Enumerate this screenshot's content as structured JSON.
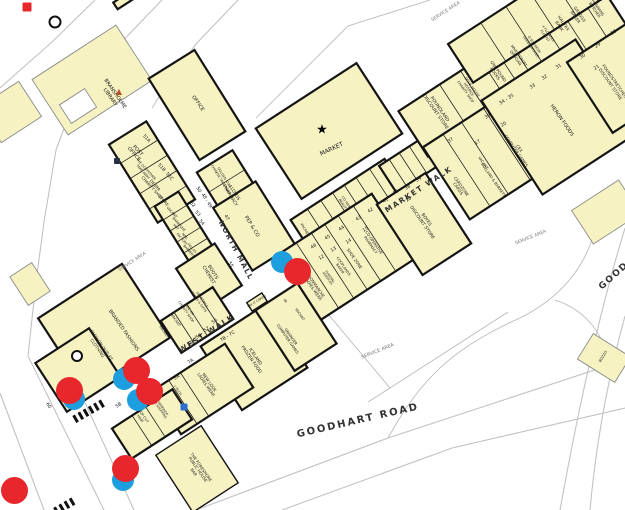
{
  "map": {
    "colors": {
      "building_fill": "#f7f2c2",
      "outline_heavy": "#141414",
      "outline_light": "#8a8a8a",
      "road": "#c2c2c2",
      "marker_red": "#e8272c",
      "marker_blue": "#1d9fdf",
      "triangle_symbol": "#b4532a",
      "phone_symbol": "#2d6fd1"
    },
    "streets": [
      {
        "t": "NORTH MALL",
        "x": 235,
        "y": 251,
        "rot": 62,
        "size": 7,
        "ls": 1.5
      },
      {
        "t": "MARKET WALK",
        "x": 419,
        "y": 190,
        "rot": -33,
        "size": 7.5,
        "ls": 1.5
      },
      {
        "t": "WEST WALK",
        "x": 207,
        "y": 334,
        "rot": -33,
        "size": 7.5,
        "ls": 1.5
      },
      {
        "t": "GOODHART ROAD",
        "x": 358,
        "y": 421,
        "rot": -13,
        "size": 10,
        "ls": 2
      },
      {
        "t": "GOODHART ROAD",
        "x": 641,
        "y": 252,
        "rot": -42,
        "size": 9,
        "ls": 1.5
      }
    ],
    "areas": [
      {
        "t": "SERVICE AREA",
        "x": 446,
        "y": 12,
        "rot": -33,
        "size": 4.6
      },
      {
        "t": "SERVICE AREA",
        "x": 133,
        "y": 263,
        "rot": -33,
        "size": 4.4
      },
      {
        "t": "SERVICE AREA",
        "x": 531,
        "y": 238,
        "rot": -22,
        "size": 4.6
      },
      {
        "t": "SERVICE AREA",
        "x": 378,
        "y": 352,
        "rot": -22,
        "size": 4.8
      }
    ],
    "units": [
      {
        "name": "bransholme-library",
        "lines": [
          "BRANSHOLME",
          "LIBRARY"
        ],
        "x": 112,
        "y": 96,
        "rot": 55,
        "size": 5
      },
      {
        "name": "office",
        "lines": [
          "OFFICE"
        ],
        "x": 197,
        "y": 104,
        "rot": 55,
        "size": 5
      },
      {
        "name": "post-office",
        "lines": [
          "POST",
          "OFFICE"
        ],
        "x": 135,
        "y": 153,
        "rot": 48,
        "size": 4.8
      },
      {
        "name": "godfather-takeaway",
        "lines": [
          "THE GODFATHER",
          "TAKE AWAY"
        ],
        "x": 144,
        "y": 171,
        "rot": 48,
        "size": 3.3
      },
      {
        "name": "debra-charity",
        "lines": [
          "DEBRA",
          "CHARITY SHOP"
        ],
        "x": 153,
        "y": 187,
        "rot": 48,
        "size": 4
      },
      {
        "name": "store",
        "lines": [
          "STORE"
        ],
        "x": 163,
        "y": 201,
        "rot": 48,
        "size": 4
      },
      {
        "name": "vacant-52",
        "lines": [
          "VACANT"
        ],
        "x": 171,
        "y": 213,
        "rot": 48,
        "size": 3.5
      },
      {
        "name": "barbeque-hut",
        "lines": [
          "BARBEQUE",
          "HUT"
        ],
        "x": 177,
        "y": 226,
        "rot": 48,
        "size": 3.2
      },
      {
        "name": "nail-factory",
        "lines": [
          "NAIL",
          "FACTORY"
        ],
        "x": 183,
        "y": 238,
        "rot": 48,
        "size": 3.2
      },
      {
        "name": "fellas-barbers",
        "lines": [
          "FELLAS",
          "BARBERS"
        ],
        "x": 190,
        "y": 250,
        "rot": 48,
        "size": 3.2
      },
      {
        "name": "golden-star",
        "lines": [
          "GOLDEN STAR",
          "CHINESE TAKE AWAY"
        ],
        "x": 222,
        "y": 179,
        "rot": 58,
        "size": 3.3
      },
      {
        "name": "lloyds-pharmacy",
        "lines": [
          "LLOYDS",
          "PHARMACY"
        ],
        "x": 231,
        "y": 195,
        "rot": 58,
        "size": 4.4
      },
      {
        "name": "pep-and-co",
        "lines": [
          "PEP & CO"
        ],
        "x": 251,
        "y": 227,
        "rot": 58,
        "size": 5
      },
      {
        "name": "boots-chemist",
        "lines": [
          "BOOTS",
          "CHEMIST"
        ],
        "x": 210,
        "y": 274,
        "rot": 58,
        "size": 4.6
      },
      {
        "name": "greetings-cards",
        "lines": [
          "GREETINGS",
          "CARDS & GIFTS"
        ],
        "x": 200,
        "y": 301,
        "rot": 55,
        "size": 3.2
      },
      {
        "name": "age-uk",
        "lines": [
          "AGE UK",
          "CHARITY SHOP"
        ],
        "x": 187,
        "y": 311,
        "rot": 55,
        "size": 3.4
      },
      {
        "name": "vacant-58",
        "lines": [
          "VACANT"
        ],
        "x": 175,
        "y": 321,
        "rot": 55,
        "size": 3.5
      },
      {
        "name": "vacant-59",
        "lines": [
          "VACANT"
        ],
        "x": 163,
        "y": 332,
        "rot": 55,
        "size": 3.5
      },
      {
        "name": "branded-fashions",
        "lines": [
          "BRANDED FASHIONS"
        ],
        "x": 123,
        "y": 331,
        "rot": 55,
        "size": 4.8
      },
      {
        "name": "fashion-outlet",
        "lines": [
          "FASHION OUTLET",
          "CLOTHING"
        ],
        "x": 99,
        "y": 347,
        "rot": 55,
        "size": 4.2
      },
      {
        "name": "cards-kiosk",
        "lines": [
          "SAY IT CARDS"
        ],
        "x": 257,
        "y": 302,
        "rot": -33,
        "size": 3.1
      },
      {
        "name": "co-hair-beauty",
        "lines": [
          "CO HAIR",
          "BEAUTY"
        ],
        "x": 344,
        "y": 204,
        "rot": 55,
        "size": 3.4
      },
      {
        "name": "vacant-46",
        "lines": [
          "VACANT"
        ],
        "x": 304,
        "y": 230,
        "rot": 58,
        "size": 3.5
      },
      {
        "name": "poundland",
        "lines": [
          "POUNDLAND",
          "DISCOUNT STORE"
        ],
        "x": 437,
        "y": 111,
        "rot": 55,
        "size": 4.6
      },
      {
        "name": "dove-house-hospice",
        "lines": [
          "DOVE HOUSE",
          "HOSPICE",
          "CHARITY SHOP"
        ],
        "x": 468,
        "y": 90,
        "rot": 55,
        "size": 3.5
      },
      {
        "name": "one-pound-books",
        "lines": [
          "ONE POUND",
          "BOOKS"
        ],
        "x": 496,
        "y": 73,
        "rot": 55,
        "size": 4
      },
      {
        "name": "wheatcroft-optician",
        "lines": [
          "WHEATCROFT",
          "OPTICIAN"
        ],
        "x": 517,
        "y": 57,
        "rot": 55,
        "size": 3.7
      },
      {
        "name": "greengrocer",
        "lines": [
          "O SO FRESH",
          "GREENGROCER"
        ],
        "x": 532,
        "y": 46,
        "rot": 55,
        "size": 3.3
      },
      {
        "name": "florist",
        "lines": [
          "4 FLOWERS",
          "FLORIST"
        ],
        "x": 546,
        "y": 35,
        "rot": 55,
        "size": 3.3
      },
      {
        "name": "halifax-bank",
        "lines": [
          "HALIFAX",
          "BANK"
        ],
        "x": 561,
        "y": 25,
        "rot": 55,
        "size": 4.2
      },
      {
        "name": "greggs-baker",
        "lines": [
          "GREGGS",
          "BAKER"
        ],
        "x": 577,
        "y": 16,
        "rot": 55,
        "size": 4.2
      },
      {
        "name": "hosmans-butcher",
        "lines": [
          "HOSMANS",
          "BUTCHER"
        ],
        "x": 596,
        "y": 9,
        "rot": 55,
        "size": 3.7
      },
      {
        "name": "market-hall",
        "lines": [
          "MARKET"
        ],
        "x": 332,
        "y": 150,
        "rot": -25,
        "size": 6
      },
      {
        "name": "poundstretcher",
        "lines": [
          "POUNDSTRETCHER",
          "DISCOUNT STORE"
        ],
        "x": 612,
        "y": 83,
        "rot": 55,
        "size": 4.2
      },
      {
        "name": "heron-foods",
        "lines": [
          "HERON FOODS"
        ],
        "x": 561,
        "y": 121,
        "rot": 55,
        "size": 5
      },
      {
        "name": "cex-games",
        "lines": [
          "CEX",
          "COMPUTER GAMES"
        ],
        "x": 517,
        "y": 150,
        "rot": 55,
        "size": 4
      },
      {
        "name": "vacant-17",
        "lines": [
          "VACANT"
        ],
        "x": 483,
        "y": 163,
        "rot": 55,
        "size": 3.7
      },
      {
        "name": "holland-barrett",
        "lines": [
          "HOLLAND & BARRETT"
        ],
        "x": 493,
        "y": 180,
        "rot": 55,
        "size": 3.7
      },
      {
        "name": "cardzone",
        "lines": [
          "CARDZONE",
          "CARDS"
        ],
        "x": 459,
        "y": 188,
        "rot": 55,
        "size": 4
      },
      {
        "name": "boyes",
        "lines": [
          "BOYES",
          "DISCOUNT STORE"
        ],
        "x": 423,
        "y": 222,
        "rot": 55,
        "size": 4.4
      },
      {
        "name": "coop-pharmacy",
        "lines": [
          "CO-OPERATIVE",
          "PHARMACY"
        ],
        "x": 372,
        "y": 244,
        "rot": 55,
        "size": 3.7
      },
      {
        "name": "shoe-zone",
        "lines": [
          "SHOE ZONE"
        ],
        "x": 354,
        "y": 259,
        "rot": 55,
        "size": 4
      },
      {
        "name": "cooplands-baker",
        "lines": [
          "COOPLANDS",
          "BAKER"
        ],
        "x": 341,
        "y": 268,
        "rot": 55,
        "size": 3.5
      },
      {
        "name": "funeral-services",
        "lines": [
          "FUNERAL",
          "SERVICES"
        ],
        "x": 328,
        "y": 278,
        "rot": 55,
        "size": 3.1
      },
      {
        "name": "bonmarche",
        "lines": [
          "BONMARCHE",
          "LADIES WEAR"
        ],
        "x": 314,
        "y": 288,
        "rot": 55,
        "size": 4
      },
      {
        "name": "vacant-9",
        "lines": [
          "VACANT"
        ],
        "x": 299,
        "y": 315,
        "rot": 55,
        "size": 3.5
      },
      {
        "name": "grainger-games",
        "lines": [
          "GRAINGER",
          "COMPUTER GAMES"
        ],
        "x": 289,
        "y": 338,
        "rot": 55,
        "size": 3.7
      },
      {
        "name": "iceland",
        "lines": [
          "ICELAND",
          "FROZEN FOOD"
        ],
        "x": 252,
        "y": 359,
        "rot": 55,
        "size": 4.4
      },
      {
        "name": "new-look",
        "lines": [
          "NEW LOOK",
          "LADIES WEAR"
        ],
        "x": 207,
        "y": 384,
        "rot": 55,
        "size": 4
      },
      {
        "name": "itech",
        "lines": [
          "I TECH"
        ],
        "x": 177,
        "y": 391,
        "rot": 55,
        "size": 3.3
      },
      {
        "name": "webshop",
        "lines": [
          "THE WEBSHOP",
          "HOME SHOPPING"
        ],
        "x": 159,
        "y": 407,
        "rot": 55,
        "size": 3.1
      },
      {
        "name": "top-cut-hair",
        "lines": [
          "TOP CUT",
          "HAIR"
        ],
        "x": 141,
        "y": 418,
        "rot": 55,
        "size": 3.5
      },
      {
        "name": "foreshore-pub",
        "lines": [
          "THE FORESHORE",
          "PUBLIC HOUSE",
          "BAR"
        ],
        "x": 197,
        "y": 470,
        "rot": 55,
        "size": 4
      },
      {
        "name": "bozzo",
        "lines": [
          "BOZZO"
        ],
        "x": 604,
        "y": 357,
        "rot": -58,
        "size": 3.5
      }
    ],
    "numbers": [
      {
        "t": "51A",
        "x": 146,
        "y": 139,
        "rot": 48
      },
      {
        "t": "51B",
        "x": 161,
        "y": 168,
        "rot": 48
      },
      {
        "t": "51C",
        "x": 169,
        "y": 177,
        "rot": 48
      },
      {
        "t": "50",
        "x": 198,
        "y": 190,
        "rot": 58
      },
      {
        "t": "48 - 49",
        "x": 206,
        "y": 201,
        "rot": 58
      },
      {
        "t": "47",
        "x": 226,
        "y": 218,
        "rot": 58
      },
      {
        "t": "55",
        "x": 230,
        "y": 265,
        "rot": 58
      },
      {
        "t": "52",
        "x": 192,
        "y": 205,
        "rot": 48
      },
      {
        "t": "53",
        "x": 197,
        "y": 214,
        "rot": 48
      },
      {
        "t": "54",
        "x": 201,
        "y": 223,
        "rot": 48
      },
      {
        "t": "56",
        "x": 215,
        "y": 322,
        "rot": -33
      },
      {
        "t": "57",
        "x": 207,
        "y": 330,
        "rot": -33
      },
      {
        "t": "58",
        "x": 199,
        "y": 337,
        "rot": -33
      },
      {
        "t": "59",
        "x": 191,
        "y": 344,
        "rot": -33
      },
      {
        "t": "60",
        "x": 48,
        "y": 406,
        "rot": 55
      },
      {
        "t": "7A",
        "x": 191,
        "y": 362,
        "rot": -33
      },
      {
        "t": "5A",
        "x": 177,
        "y": 378,
        "rot": -33
      },
      {
        "t": "5B",
        "x": 119,
        "y": 406,
        "rot": -33
      },
      {
        "t": "7B - 7C",
        "x": 228,
        "y": 337,
        "rot": -33
      },
      {
        "t": "9",
        "x": 286,
        "y": 302,
        "rot": -33
      },
      {
        "t": "11",
        "x": 306,
        "y": 268,
        "rot": -33
      },
      {
        "t": "12",
        "x": 322,
        "y": 258,
        "rot": -33
      },
      {
        "t": "13",
        "x": 334,
        "y": 250,
        "rot": -33
      },
      {
        "t": "14",
        "x": 349,
        "y": 242,
        "rot": -33
      },
      {
        "t": "15",
        "x": 366,
        "y": 230,
        "rot": -33
      },
      {
        "t": "16",
        "x": 409,
        "y": 200,
        "rot": -33
      },
      {
        "t": "17",
        "x": 478,
        "y": 143,
        "rot": -33
      },
      {
        "t": "20",
        "x": 504,
        "y": 125,
        "rot": -33
      },
      {
        "t": "21",
        "x": 597,
        "y": 68,
        "rot": -33
      },
      {
        "t": "40",
        "x": 396,
        "y": 193,
        "rot": -33
      },
      {
        "t": "41",
        "x": 386,
        "y": 201,
        "rot": -33
      },
      {
        "t": "42",
        "x": 371,
        "y": 211,
        "rot": -33
      },
      {
        "t": "43",
        "x": 359,
        "y": 219,
        "rot": -33
      },
      {
        "t": "44",
        "x": 342,
        "y": 229,
        "rot": -33
      },
      {
        "t": "45",
        "x": 328,
        "y": 238,
        "rot": -33
      },
      {
        "t": "46",
        "x": 314,
        "y": 247,
        "rot": -33
      },
      {
        "t": "38",
        "x": 408,
        "y": 188,
        "rot": -33
      },
      {
        "t": "39",
        "x": 419,
        "y": 180,
        "rot": -33
      },
      {
        "t": "37",
        "x": 451,
        "y": 141,
        "rot": -33
      },
      {
        "t": "36",
        "x": 488,
        "y": 117,
        "rot": -33
      },
      {
        "t": "34 - 35",
        "x": 507,
        "y": 100,
        "rot": -33
      },
      {
        "t": "33",
        "x": 533,
        "y": 87,
        "rot": -33
      },
      {
        "t": "32",
        "x": 545,
        "y": 78,
        "rot": -33
      },
      {
        "t": "31",
        "x": 559,
        "y": 67,
        "rot": -33
      },
      {
        "t": "30",
        "x": 583,
        "y": 57,
        "rot": -33
      },
      {
        "t": "29",
        "x": 598,
        "y": 46,
        "rot": -33
      },
      {
        "t": "28",
        "x": 614,
        "y": 33,
        "rot": -33
      }
    ],
    "symbols": [
      {
        "type": "star",
        "name": "market-star-symbol",
        "x": 322,
        "y": 130,
        "size": 13,
        "color": "#000"
      },
      {
        "type": "triangle",
        "name": "library-triangle-symbol",
        "x": 119,
        "y": 92,
        "size": 8,
        "color": "#b4532a"
      },
      {
        "type": "ring",
        "name": "ring-symbol-north",
        "x": 55,
        "y": 22,
        "d": 9
      },
      {
        "type": "ring",
        "name": "ring-symbol-west",
        "x": 77,
        "y": 356,
        "d": 8
      },
      {
        "type": "square",
        "name": "red-square-symbol",
        "x": 27,
        "y": 7,
        "d": 9,
        "color": "#e8272c"
      },
      {
        "type": "square",
        "name": "post-office-icon",
        "x": 117,
        "y": 161,
        "d": 6,
        "color": "#26324a"
      },
      {
        "type": "square",
        "name": "phone-icon",
        "x": 184,
        "y": 407,
        "d": 7,
        "color": "#2d6fd1"
      }
    ],
    "markers": [
      {
        "color": "blue",
        "x": 282,
        "y": 262,
        "d": 22
      },
      {
        "color": "red",
        "x": 297,
        "y": 271,
        "d": 27
      },
      {
        "color": "blue",
        "x": 124,
        "y": 379,
        "d": 22
      },
      {
        "color": "red",
        "x": 136,
        "y": 370,
        "d": 27
      },
      {
        "color": "blue",
        "x": 138,
        "y": 400,
        "d": 22
      },
      {
        "color": "red",
        "x": 149,
        "y": 391,
        "d": 27
      },
      {
        "color": "blue",
        "x": 74,
        "y": 399,
        "d": 22
      },
      {
        "color": "red",
        "x": 69,
        "y": 390,
        "d": 27
      },
      {
        "color": "blue",
        "x": 123,
        "y": 480,
        "d": 22
      },
      {
        "color": "red",
        "x": 125,
        "y": 468,
        "d": 27
      },
      {
        "color": "red",
        "x": 14,
        "y": 490,
        "d": 27
      }
    ]
  }
}
